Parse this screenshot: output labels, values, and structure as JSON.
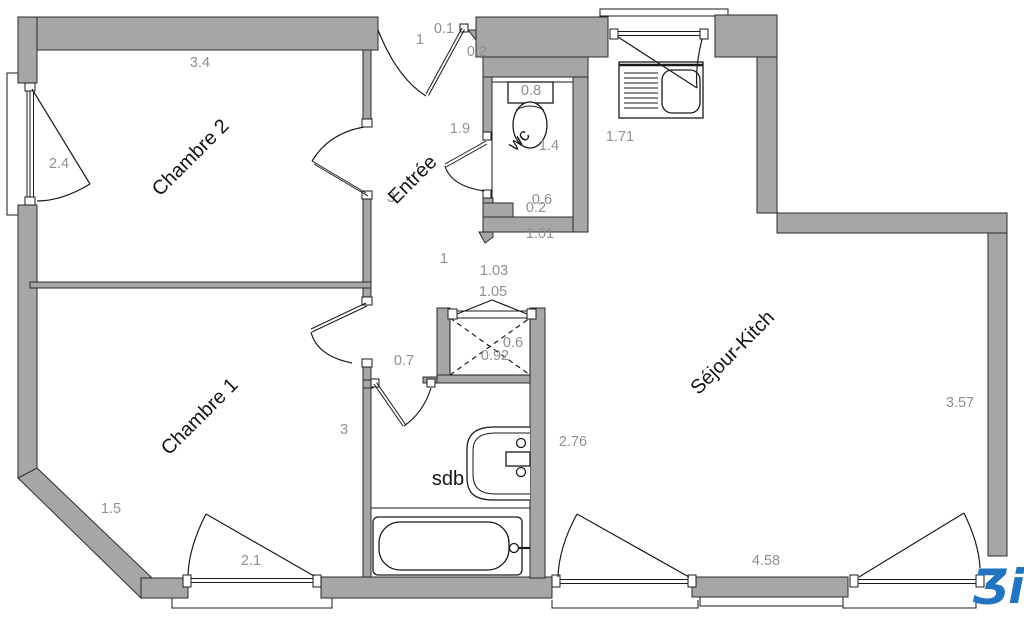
{
  "plan": {
    "type": "apartment-floor-plan",
    "rooms": [
      {
        "id": "chambre2",
        "label": "Chambre 2"
      },
      {
        "id": "chambre1",
        "label": "Chambre 1"
      },
      {
        "id": "entree",
        "label": "Entrée"
      },
      {
        "id": "wc",
        "label": "wc"
      },
      {
        "id": "sdb",
        "label": "sdb"
      },
      {
        "id": "sejour",
        "label": "Séjour-Kitch"
      }
    ],
    "dims": [
      {
        "v": "3.4"
      },
      {
        "v": "2.4"
      },
      {
        "v": "1"
      },
      {
        "v": "0.1"
      },
      {
        "v": "0.2"
      },
      {
        "v": "0.8"
      },
      {
        "v": "1.9"
      },
      {
        "v": "1.72"
      },
      {
        "v": "1.71"
      },
      {
        "v": "1.4"
      },
      {
        "v": "0.6"
      },
      {
        "v": "0.2"
      },
      {
        "v": "1.01"
      },
      {
        "v": "1"
      },
      {
        "v": "1.03"
      },
      {
        "v": "1.05"
      },
      {
        "v": "0.7"
      },
      {
        "v": "0.6"
      },
      {
        "v": "0.92"
      },
      {
        "v": "3"
      },
      {
        "v": "3"
      },
      {
        "v": "1.5"
      },
      {
        "v": "2.1"
      },
      {
        "v": "2.76"
      },
      {
        "v": "3.57"
      },
      {
        "v": "4.58"
      }
    ],
    "fixtures": [
      "kitchen-sink",
      "toilet",
      "washbasin",
      "bathtub",
      "storage-closet"
    ],
    "colors": {
      "wall": "#a6a6a6",
      "dim_text": "#909090",
      "line": "#1a1a1a",
      "logo_blue": "#2273c0",
      "background": "#ffffff"
    },
    "logo": {
      "text": "Ʒi",
      "color": "#2273c0"
    }
  }
}
